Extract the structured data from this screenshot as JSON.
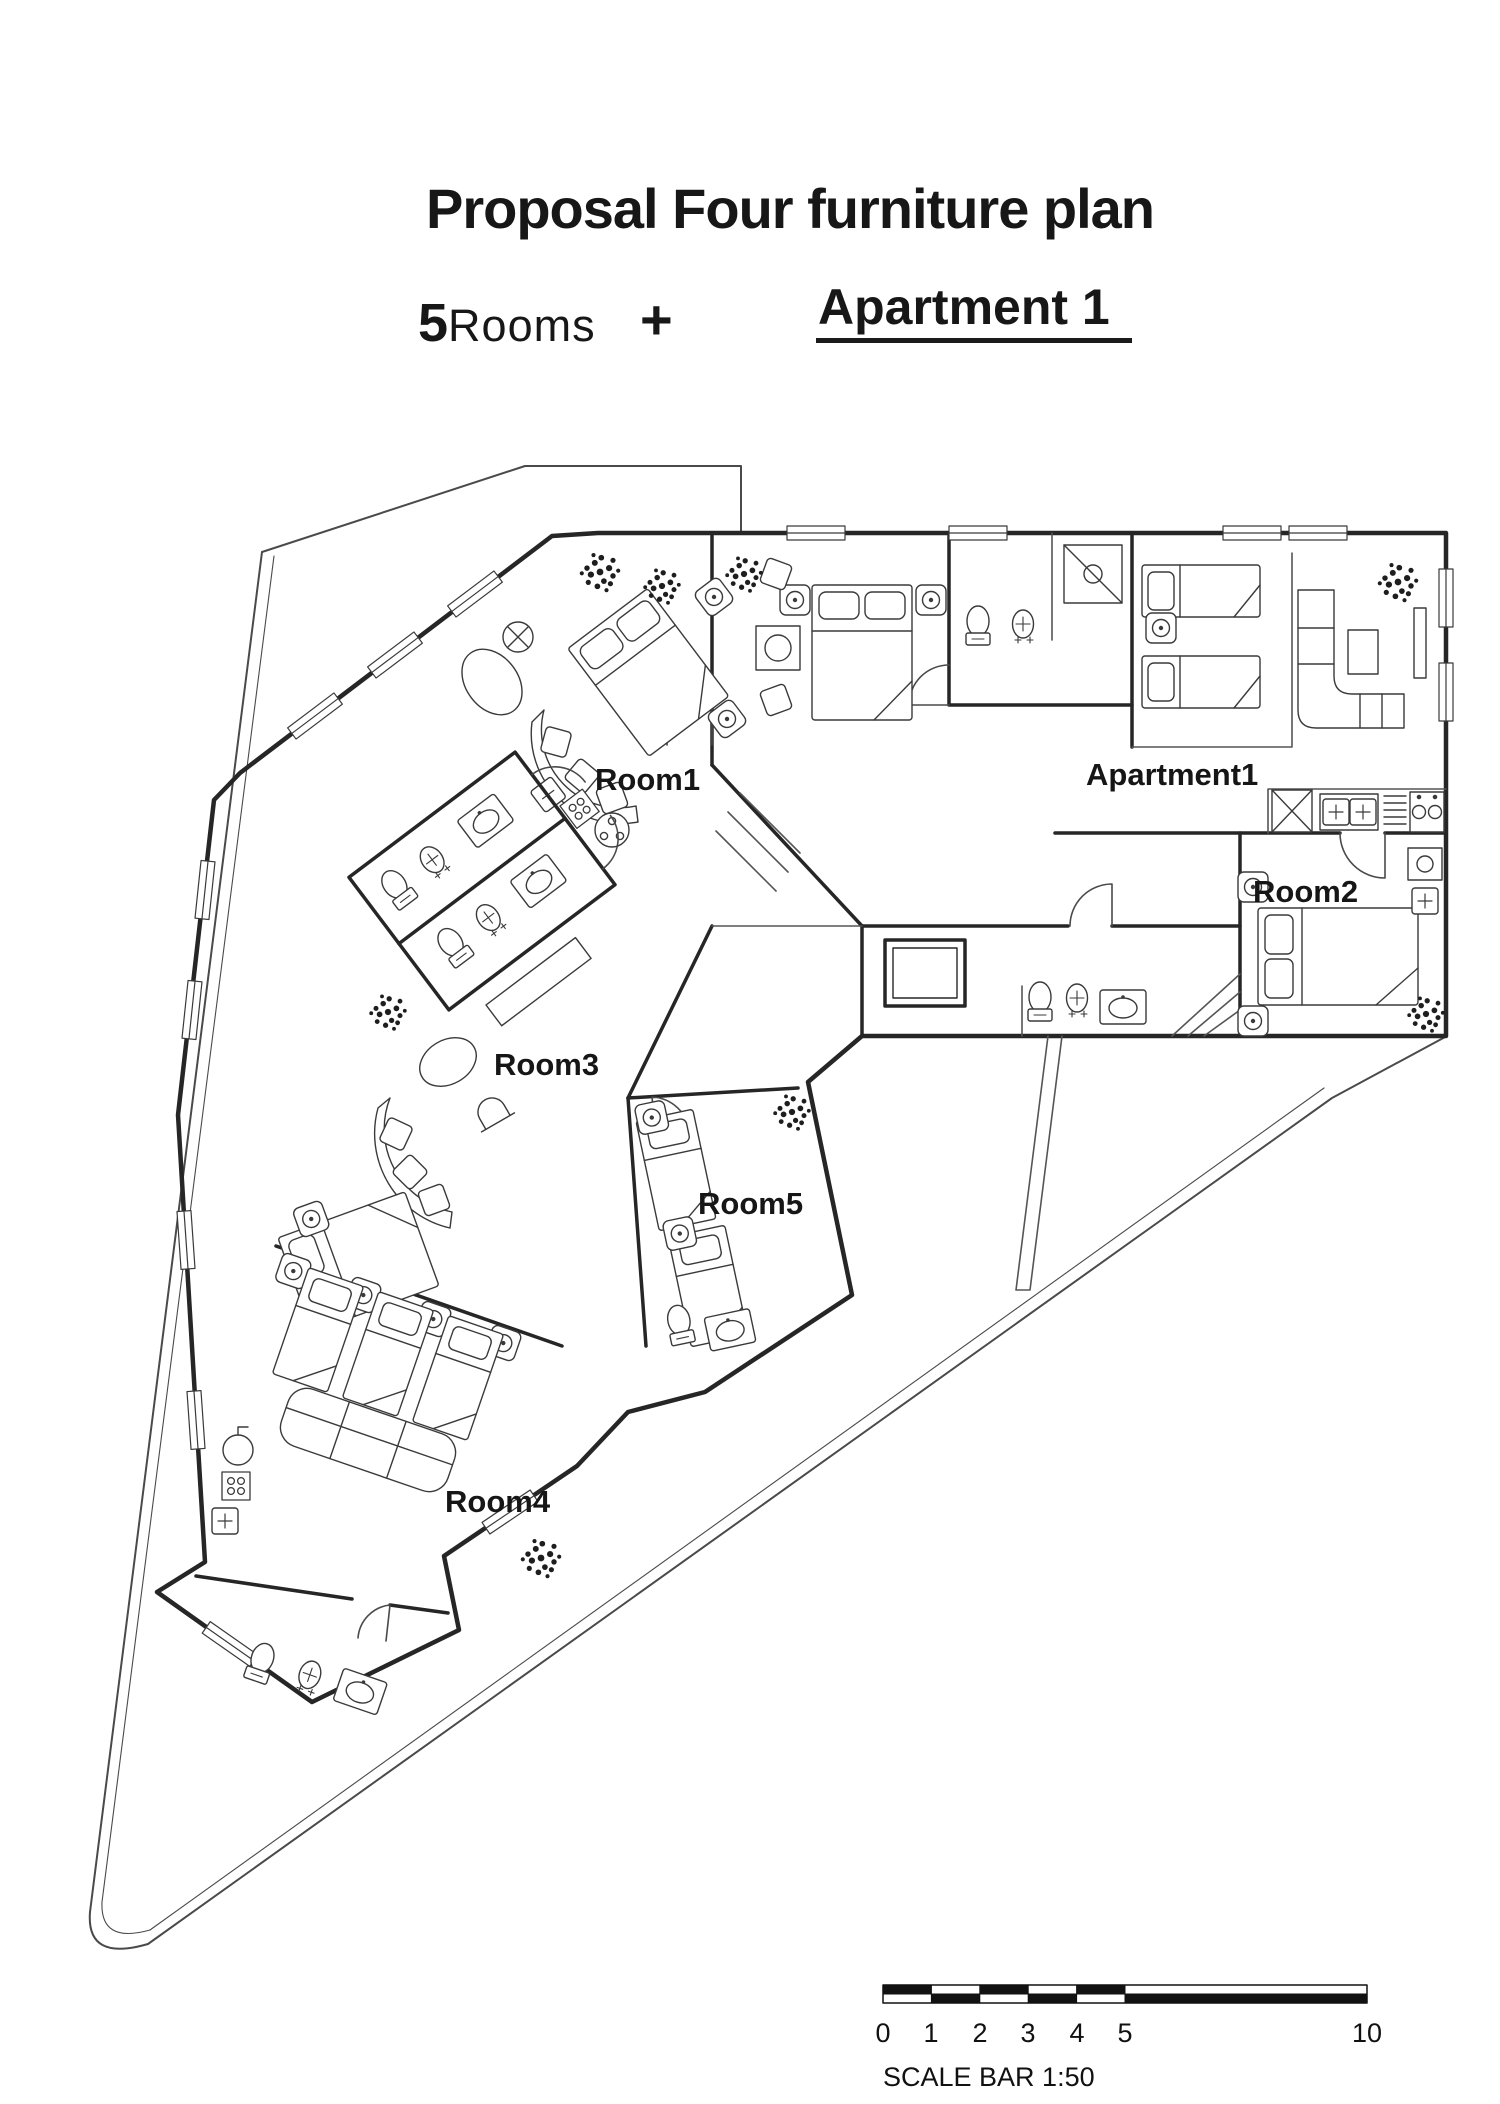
{
  "header": {
    "title": "Proposal Four furniture plan",
    "rooms_count": "5",
    "rooms_word": "Rooms",
    "plus_sign": "+",
    "apartment_label": "Apartment 1"
  },
  "plan": {
    "labels": {
      "room1": "Room1",
      "room2": "Room2",
      "room3": "Room3",
      "room4": "Room4",
      "room5": "Room5",
      "apartment1": "Apartment1"
    }
  },
  "scale_bar": {
    "ticks": [
      "0",
      "1",
      "2",
      "3",
      "4",
      "5",
      "10"
    ],
    "caption": "SCALE BAR 1:50"
  },
  "colors": {
    "ink": "#161616",
    "wall": "#262626",
    "furniture": "#3a3a3a",
    "thin": "#555555",
    "paper": "#ffffff"
  }
}
